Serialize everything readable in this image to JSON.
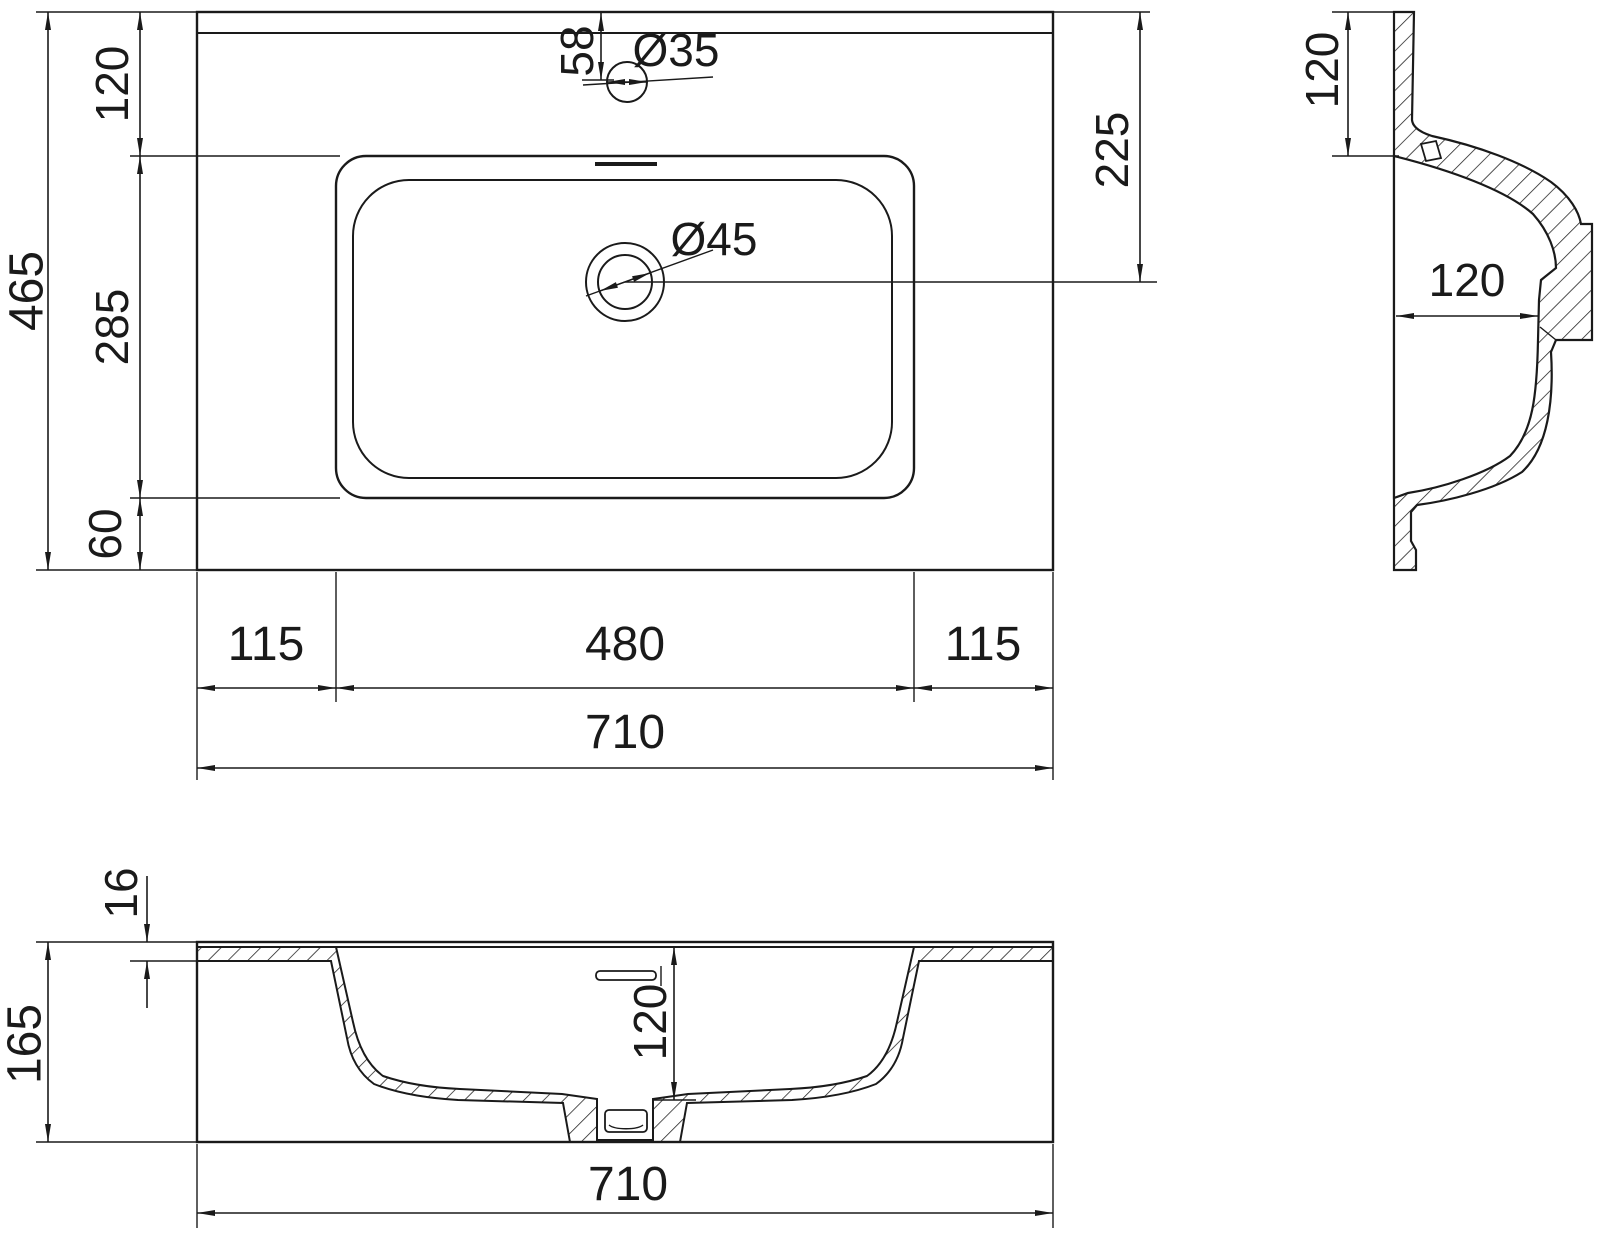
{
  "colors": {
    "line": "#1a1a1a",
    "background": "#ffffff"
  },
  "plan_view": {
    "overall_depth": "465",
    "back_margin": "120",
    "basin_length": "285",
    "front_margin": "60",
    "faucet_offset": "58",
    "faucet_hole_diameter": "Ø35",
    "drain_diameter": "Ø45",
    "drain_offset_from_back": "225",
    "left_margin": "115",
    "basin_width": "480",
    "right_margin": "115",
    "overall_width": "710"
  },
  "side_view": {
    "back_deck_width": "120",
    "bowl_depth": "120"
  },
  "front_view": {
    "rim_thickness": "16",
    "overall_height": "165",
    "bowl_depth": "120",
    "overall_width": "710"
  }
}
